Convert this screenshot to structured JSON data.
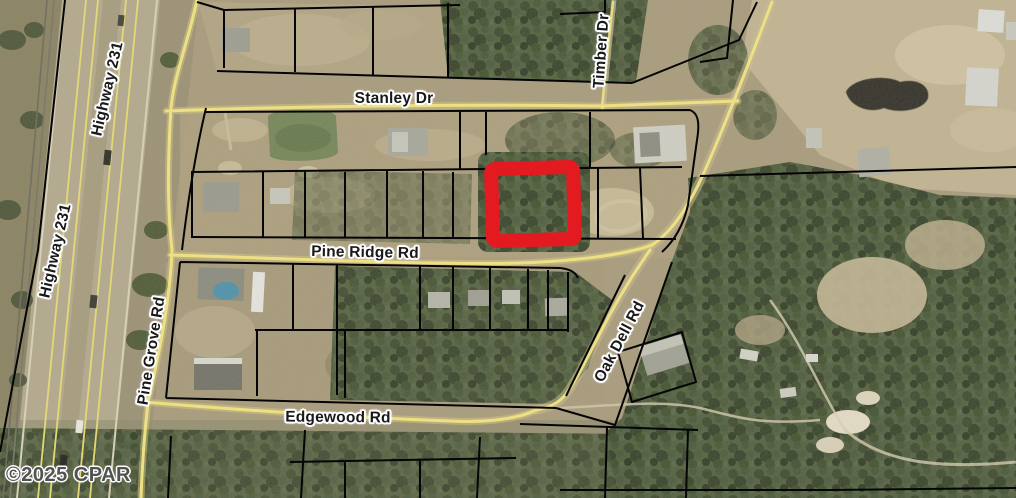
{
  "map": {
    "copyright": "©2025 CPAR",
    "highlight": {
      "shape": "rectangle",
      "color": "#e31b20"
    },
    "road_labels": {
      "highway_231_upper": "Highway 231",
      "highway_231_lower": "Highway 231",
      "pine_grove_rd": "Pine Grove Rd",
      "stanley_dr": "Stanley Dr",
      "timber_dr": "Timber Dr",
      "pine_ridge_rd": "Pine Ridge Rd",
      "oak_dell_rd": "Oak Dell Rd",
      "edgewood_rd": "Edgewood Rd"
    },
    "colors": {
      "road": "#ede084",
      "parcel_line": "#050505",
      "field_tan": "#a99c7e",
      "forest_green": "#4c583c"
    }
  }
}
